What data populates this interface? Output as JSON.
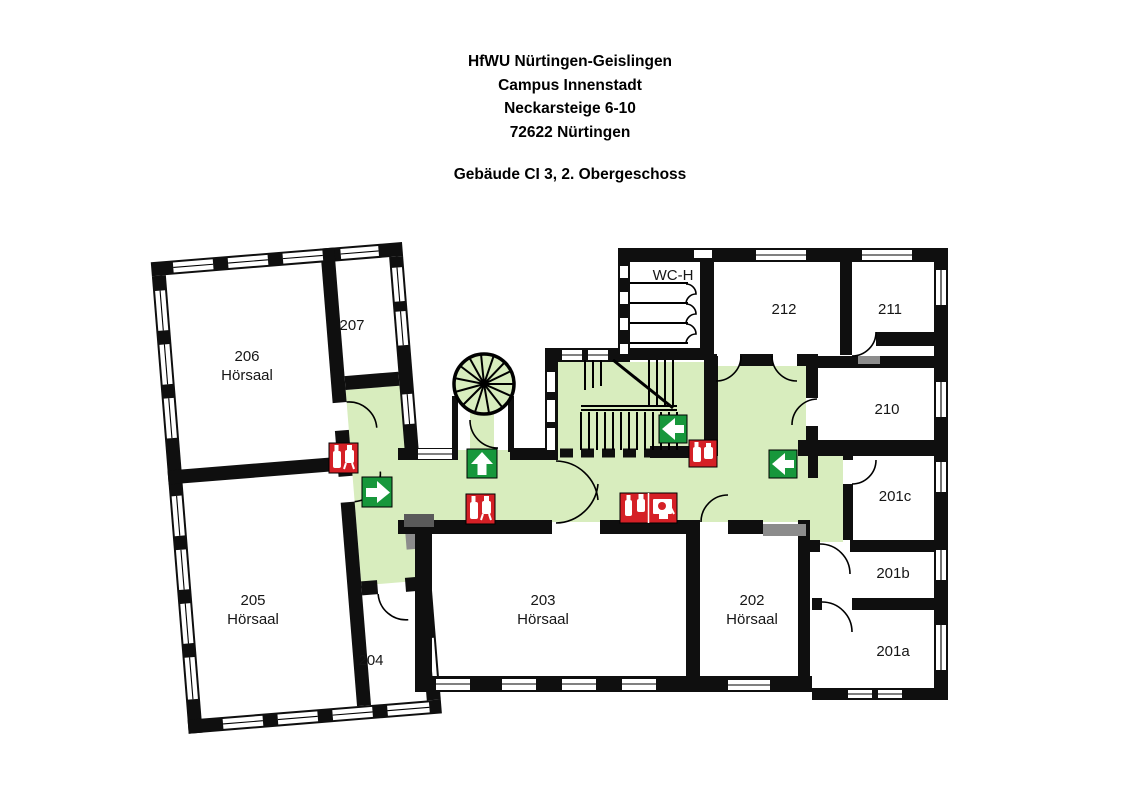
{
  "header": {
    "institution": "HfWU Nürtingen-Geislingen",
    "campus": "Campus Innenstadt",
    "street": "Neckarsteige 6-10",
    "city": "72622 Nürtingen",
    "floor_title": "Gebäude CI 3, 2. Obergeschoss"
  },
  "rooms": {
    "r206": {
      "number": "206",
      "type": "Hörsaal"
    },
    "r207": {
      "number": "207"
    },
    "r205": {
      "number": "205",
      "type": "Hörsaal"
    },
    "r204": {
      "number": "204"
    },
    "r203": {
      "number": "203",
      "type": "Hörsaal"
    },
    "r202": {
      "number": "202",
      "type": "Hörsaal"
    },
    "r212": {
      "number": "212"
    },
    "r211": {
      "number": "211"
    },
    "r210": {
      "number": "210"
    },
    "r201c": {
      "number": "201c"
    },
    "r201b": {
      "number": "201b"
    },
    "r201a": {
      "number": "201a"
    },
    "wc": {
      "number": "WC-H"
    }
  },
  "legend": {
    "escape_route_area": "escape-route (green corridor)",
    "exit_arrow_sign": "escape-route-arrow-sign",
    "fire_equipment_sign": "fire-extinguisher-hydrant-sign",
    "fire_hose_sign": "fire-hose-reel-sign",
    "spiral_stair": "spiral-staircase",
    "main_stair": "main-staircase"
  },
  "colors": {
    "corridor": "#d8edbe",
    "exit_green": "#17973b",
    "fire_red": "#d52026",
    "wall": "#0f0f0f",
    "gray": "#8c8c8c",
    "bench_gray": "#5a5a5a",
    "white": "#ffffff"
  }
}
